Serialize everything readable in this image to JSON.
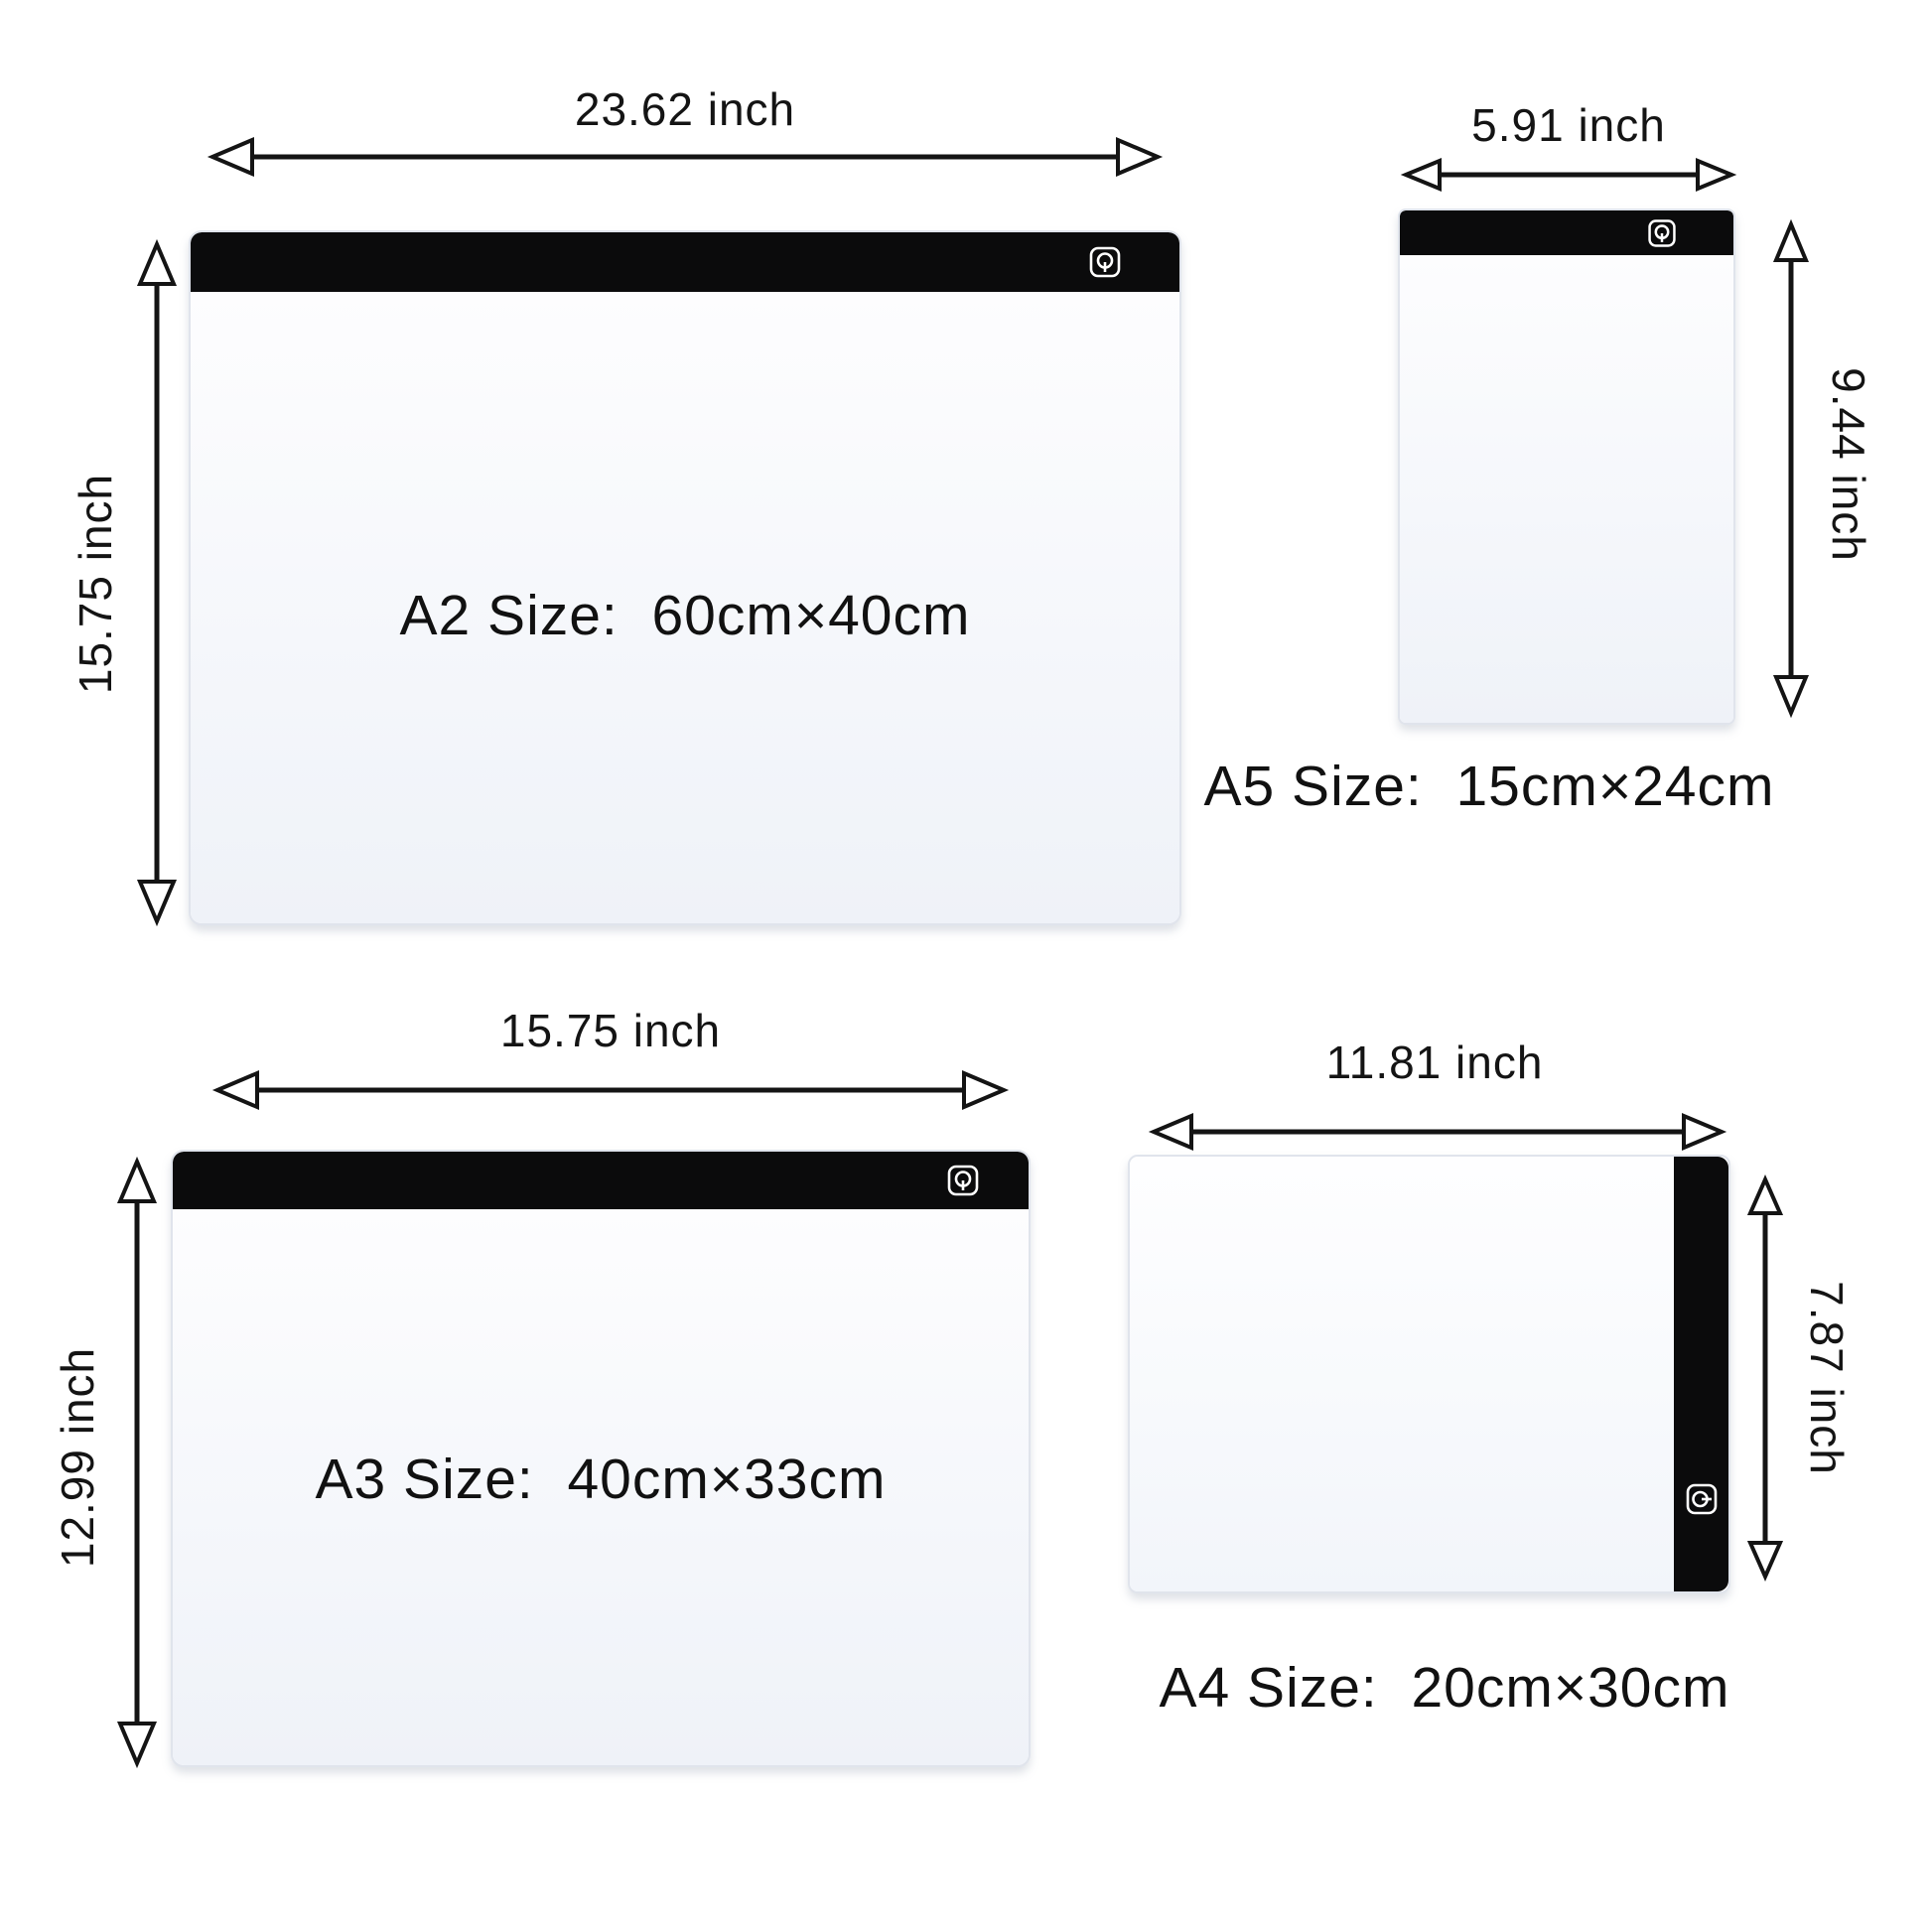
{
  "diagram": {
    "title": "LED light pad size comparison",
    "background": "#ffffff",
    "colors": {
      "frame_bar": "#0b0b0c",
      "pad_surface": "#f5f7fb",
      "pad_border": "#e0e4ec",
      "arrow": "#141414",
      "text": "#141414"
    },
    "icons": {
      "power": "power-icon"
    },
    "pads": {
      "a2": {
        "name": "A2",
        "size_label": "A2 Size:  60cm×40cm",
        "width_label": "23.62 inch",
        "height_label": "15.75 inch",
        "frame_position": "top"
      },
      "a5": {
        "name": "A5",
        "size_label": "A5 Size:  15cm×24cm",
        "width_label": "5.91 inch",
        "height_label": "9.44 inch",
        "frame_position": "top"
      },
      "a3": {
        "name": "A3",
        "size_label": "A3 Size:  40cm×33cm",
        "width_label": "15.75 inch",
        "height_label": "12.99 inch",
        "frame_position": "top"
      },
      "a4": {
        "name": "A4",
        "size_label": "A4 Size:  20cm×30cm",
        "width_label": "11.81 inch",
        "height_label": "7.87 inch",
        "frame_position": "right"
      }
    }
  }
}
